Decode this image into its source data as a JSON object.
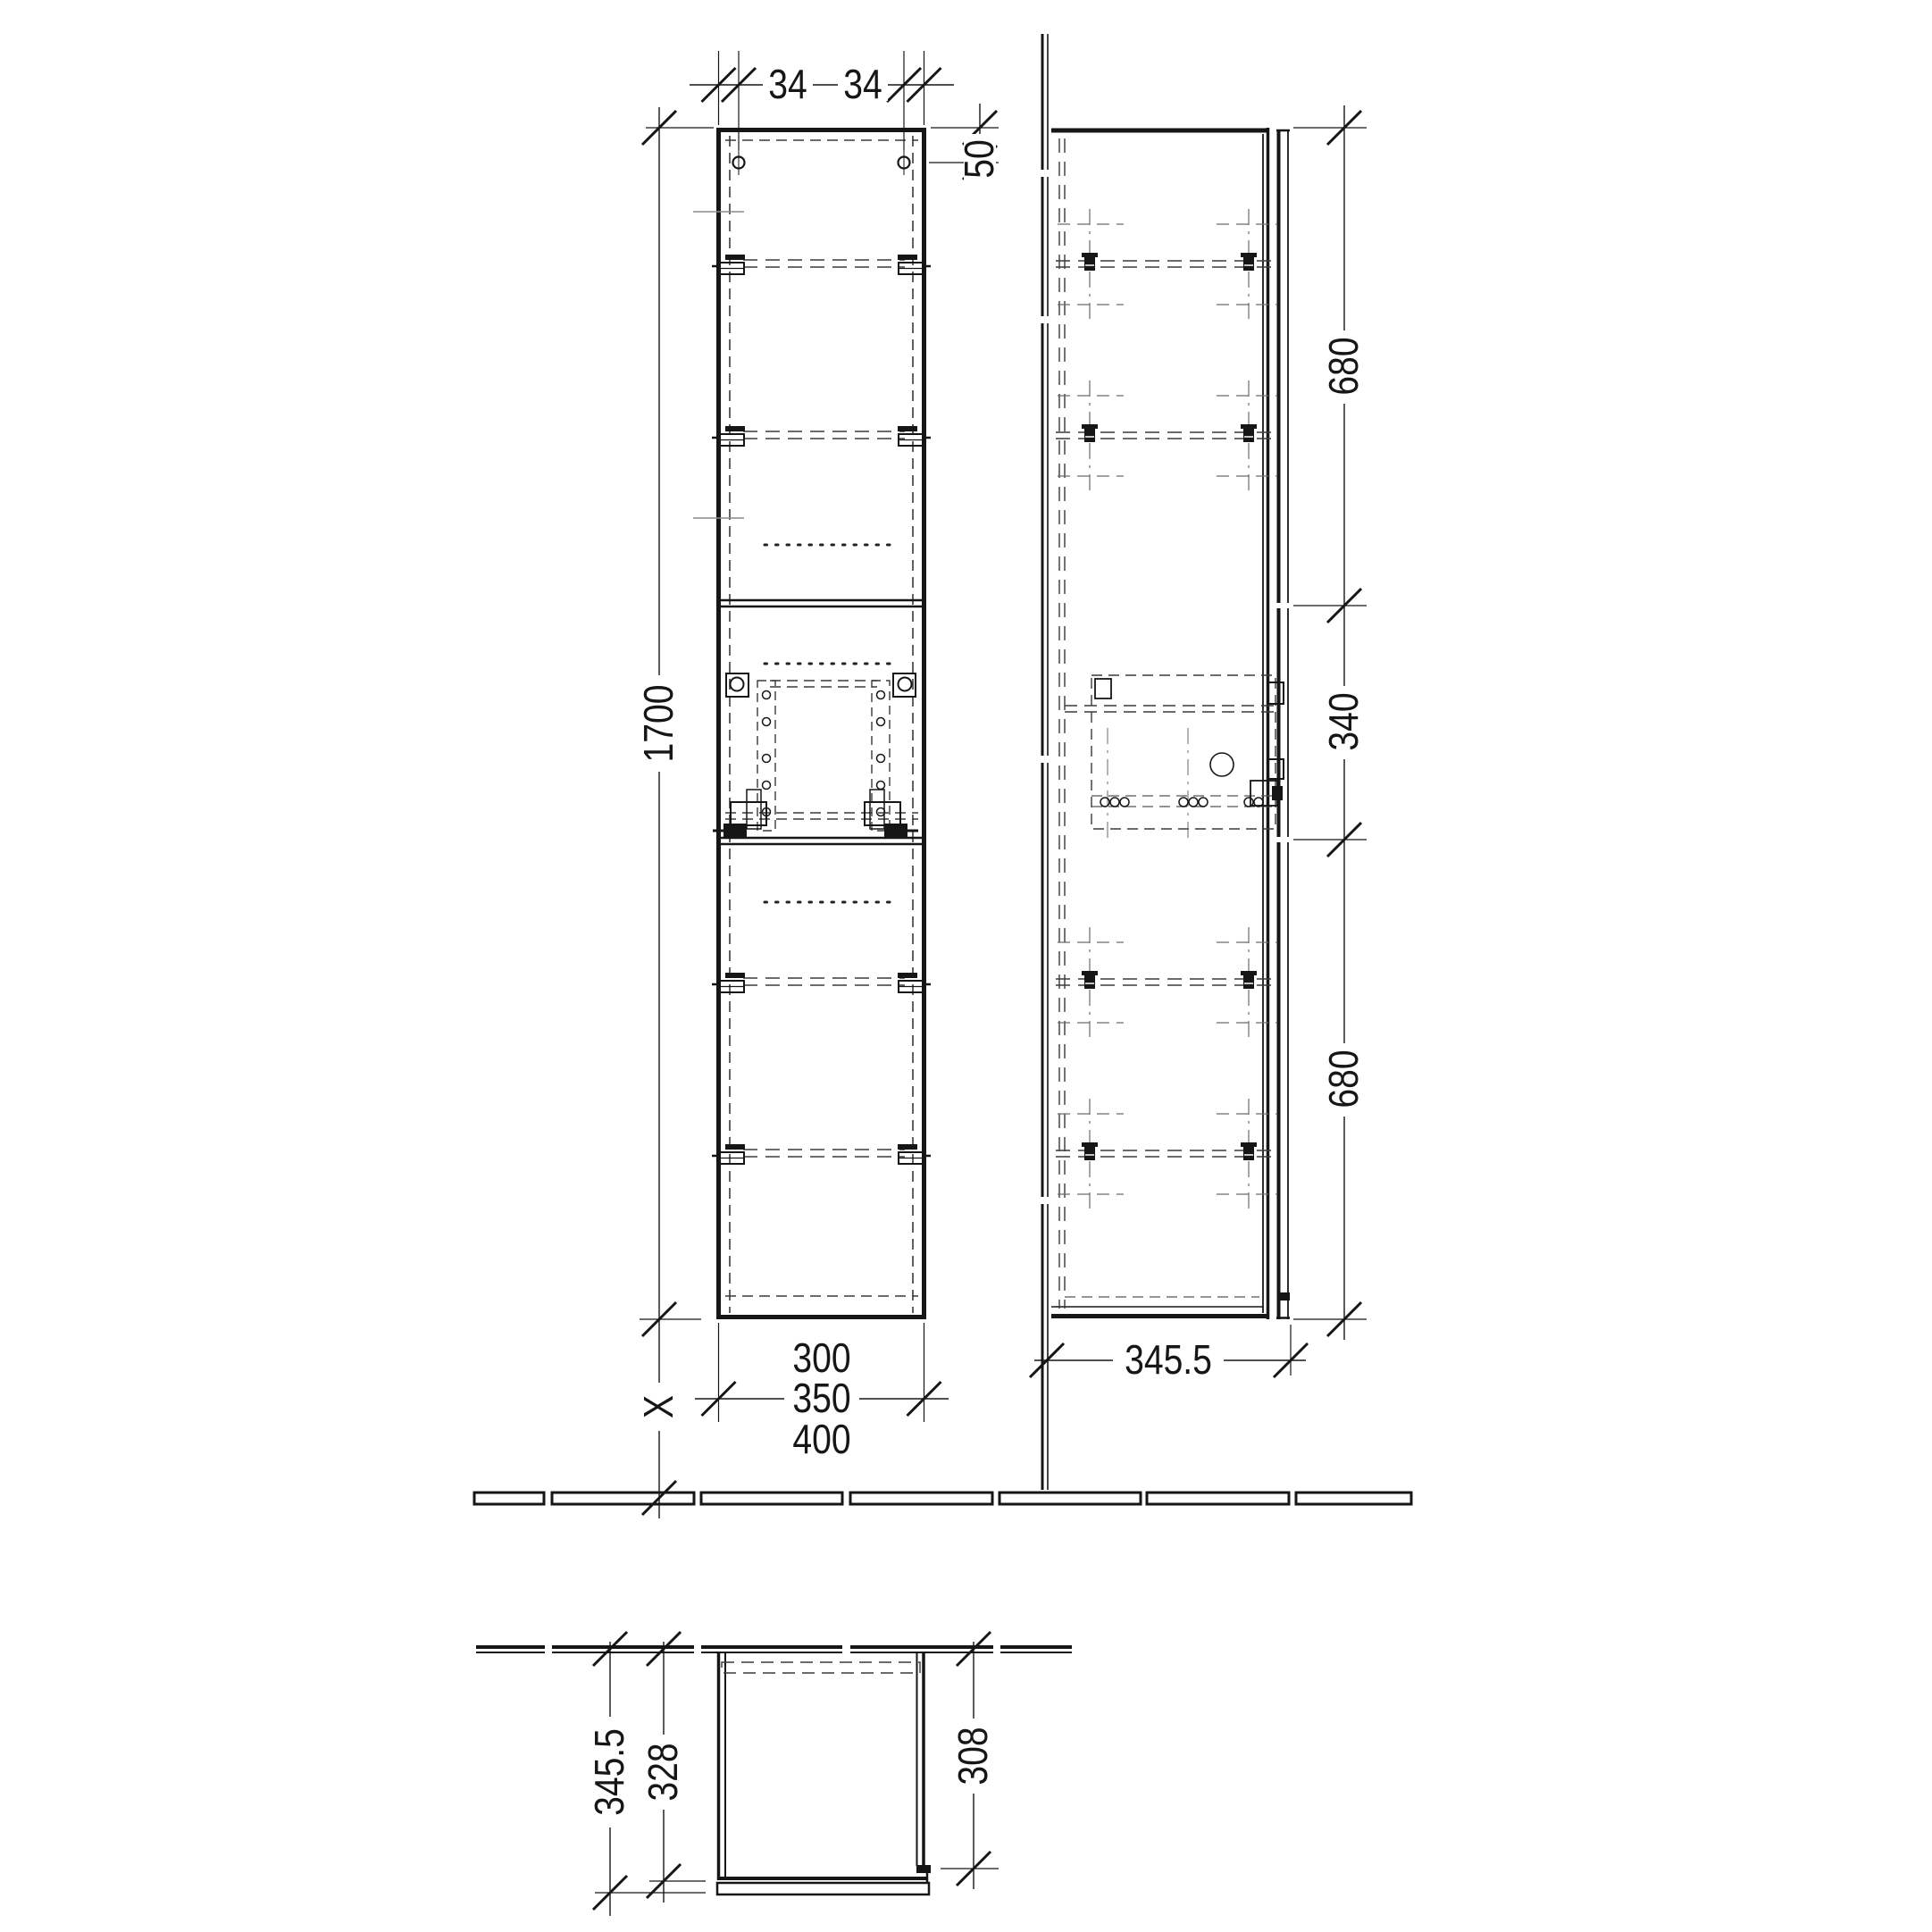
{
  "dims": {
    "top_left_inset": "34",
    "top_right_inset": "34",
    "hole_top_offset": "50",
    "cabinet_height": "1700",
    "floor_clearance": "X",
    "width_small": "300",
    "width_medium": "350",
    "width_large": "400",
    "side_top_section": "680",
    "side_middle_section": "340",
    "side_bottom_section": "680",
    "side_depth": "345.5",
    "plan_depth_overall": "345.5",
    "plan_depth_carcass": "328",
    "plan_depth_clear": "308"
  }
}
